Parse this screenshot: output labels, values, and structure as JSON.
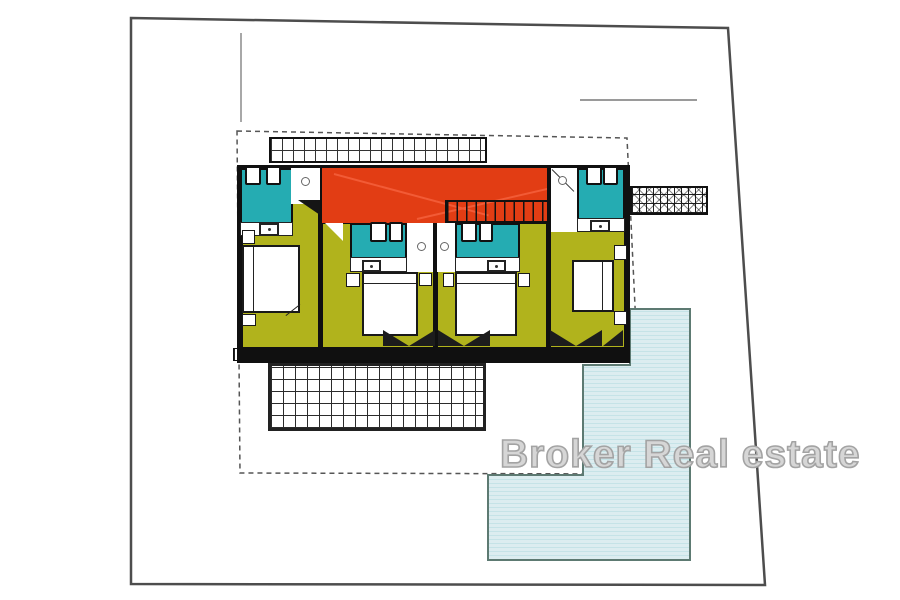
{
  "watermark": {
    "text": "Broker Real estate"
  },
  "colors": {
    "roof-terrace": "#e23d14",
    "bathroom": "#25acb2",
    "bedroom": "#b1b31c",
    "pool": "#dcedf0",
    "pool-stripe": "#c5e3e7",
    "pool-border": "#5d7a72",
    "wall": "#101010",
    "parcel-line": "#4d4d4d",
    "dashed-line": "#555555",
    "grid-line": "#2b2b2b"
  },
  "plan": {
    "type": "residential-floor-plan",
    "units": [
      {
        "name": "unit-1",
        "rooms": [
          "bathroom",
          "bedroom"
        ]
      },
      {
        "name": "unit-2",
        "rooms": [
          "bathroom",
          "bedroom"
        ]
      },
      {
        "name": "unit-3",
        "rooms": [
          "bathroom",
          "bedroom"
        ]
      },
      {
        "name": "unit-4",
        "rooms": [
          "bathroom",
          "bedroom"
        ]
      }
    ],
    "features": [
      "roof-terrace-with-stairs",
      "pergola-north",
      "pergola-east",
      "terrace-grid-south",
      "swimming-pool",
      "parcel-boundary",
      "setback-dashed-line"
    ]
  }
}
